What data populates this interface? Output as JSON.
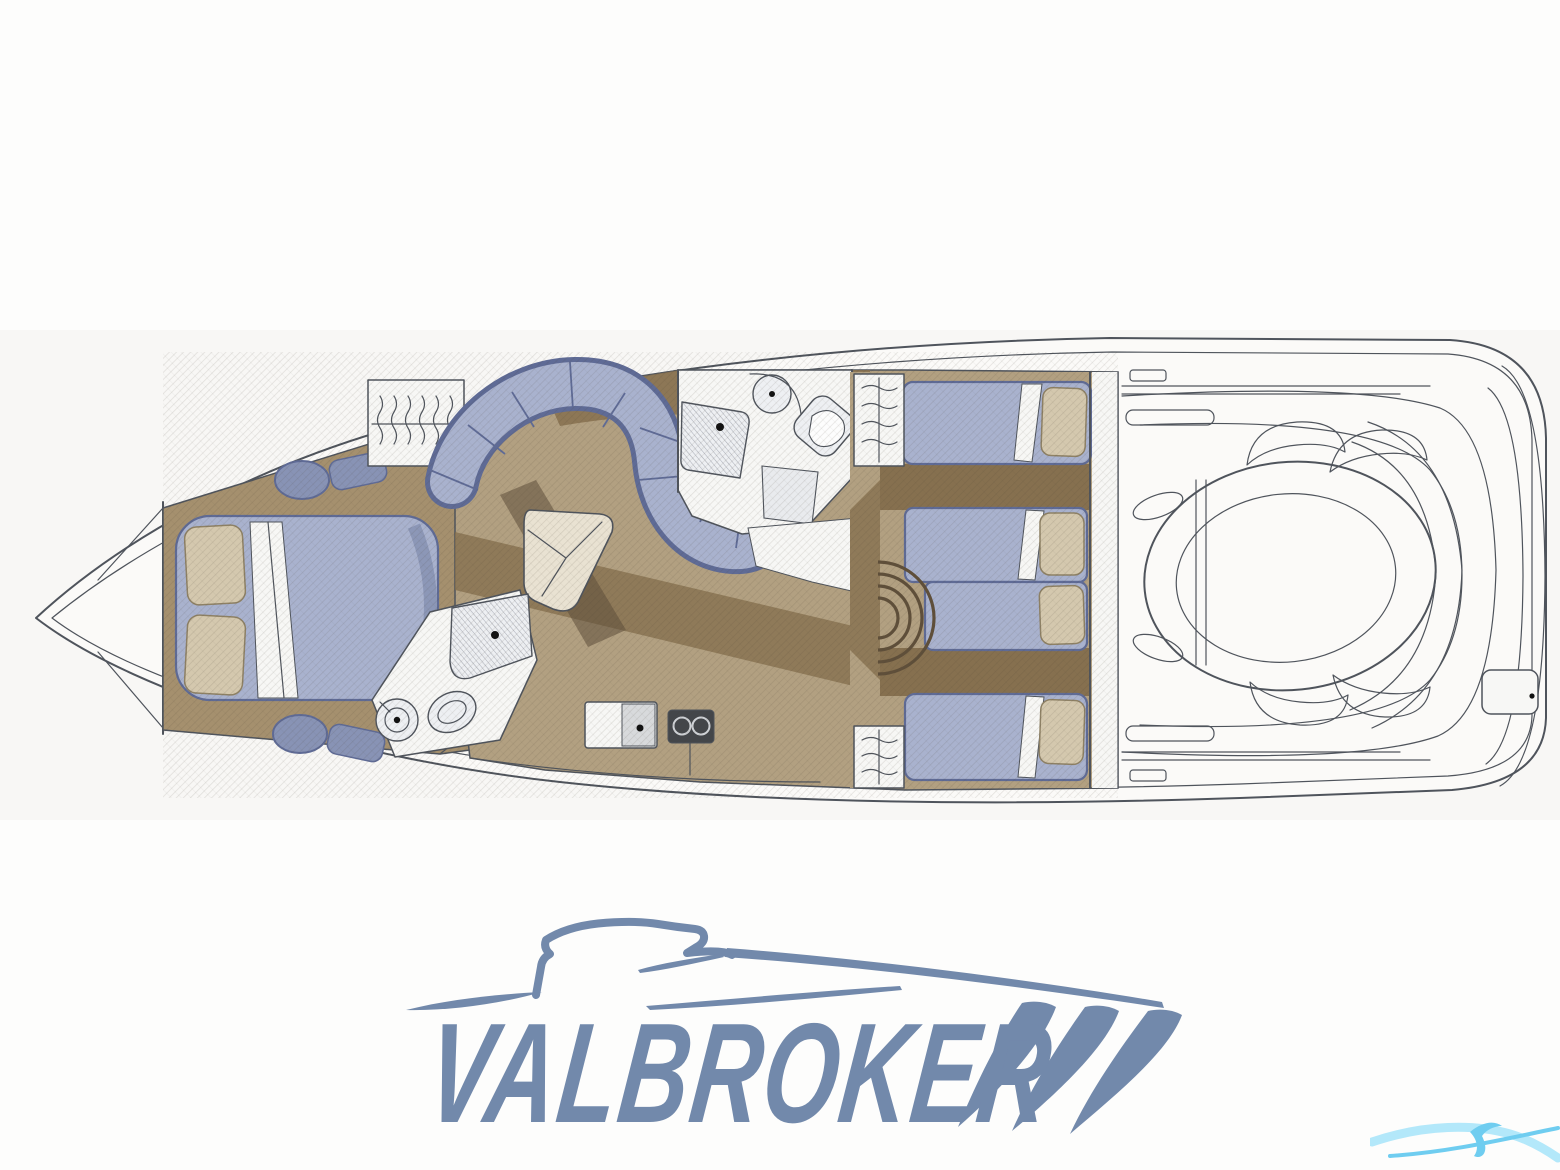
{
  "logo": {
    "text": "VALBROKER"
  },
  "palette": {
    "page": "#fdfdfc",
    "strip_bg": "#f8f7f5",
    "hull": "#fbfaf8",
    "room": "#f7f7f5",
    "line": "#4f545c",
    "floor": "#a5906e",
    "floor_light": "#b2a081",
    "floor_dark": "#86704f",
    "floor_shadow": "#5f4f3a",
    "upholstery": "#a9b2ce",
    "upholstery_edge": "#5f6b96",
    "stool": "#8893b5",
    "cushion": "#d4c8ae",
    "cushion_edge": "#8e8165",
    "fixture": "#eef0f3",
    "stove": "#43464a",
    "logo": "#7289ab",
    "watermark": "#6fcdf0",
    "watermark_light": "#b3e8fa"
  },
  "floorplan": {
    "areas": [
      {
        "name": "bow-anchor-locker"
      },
      {
        "name": "forward-owner-cabin-double-berth"
      },
      {
        "name": "wardrobe-hanging-locker"
      },
      {
        "name": "forward-head-shower-wc"
      },
      {
        "name": "salon-s-shaped-sofa"
      },
      {
        "name": "salon-table"
      },
      {
        "name": "mid-head-shower-wc"
      },
      {
        "name": "galley-sink-stove"
      },
      {
        "name": "guest-cabin-berths"
      },
      {
        "name": "companionway-steps"
      },
      {
        "name": "cockpit-deck"
      },
      {
        "name": "engine-hatch-sun-pad"
      },
      {
        "name": "swim-platform"
      }
    ]
  }
}
